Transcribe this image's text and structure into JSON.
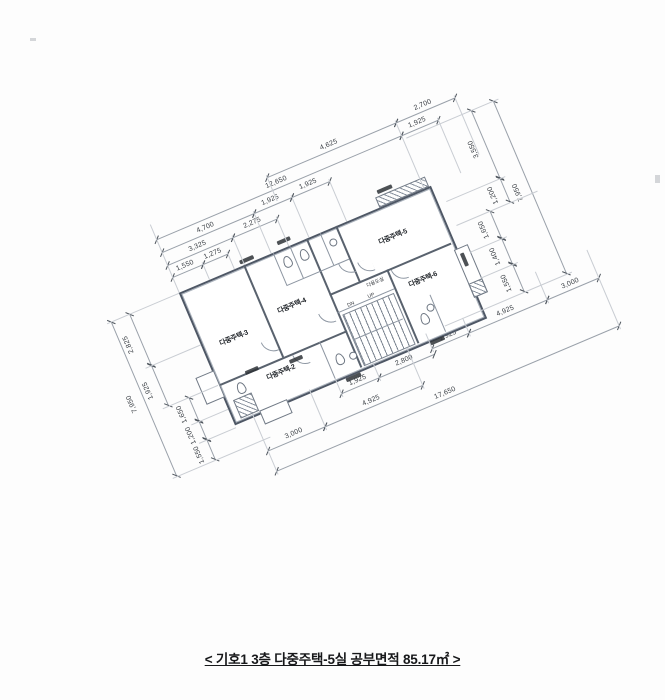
{
  "caption": "< 기호1  3층 다중주택-5실 공부면적 85.17㎡ >",
  "plan": {
    "rooms": [
      {
        "label": "다중주택-3"
      },
      {
        "label": "다중주택-4"
      },
      {
        "label": "다중주택-5"
      },
      {
        "label": "다중주택-6"
      },
      {
        "label": "다중주택-2"
      },
      {
        "label": "다용도실"
      }
    ],
    "stair": {
      "up": "UP",
      "dn": "DN"
    },
    "dims": {
      "top": [
        "4,625",
        "2,700",
        "12,650",
        "1,925",
        "4,700",
        "1,925",
        "1,925",
        "3,325",
        "2,275",
        "1,550",
        "1,275"
      ],
      "right": [
        "3,550",
        "1,200",
        "7,950",
        "1,650",
        "1,400",
        "1,550"
      ],
      "left": [
        "2,825",
        "1,925",
        "7,950",
        "1,650",
        "1,200",
        "1,550"
      ],
      "bottom": [
        "1,925",
        "2,800",
        "1,925",
        "4,925",
        "3,000",
        "3,000",
        "4,925",
        "17,650"
      ]
    }
  },
  "colors": {
    "drawing_line": "#59626e",
    "dim_line": "#9aa1aa",
    "text": "#23272c"
  }
}
